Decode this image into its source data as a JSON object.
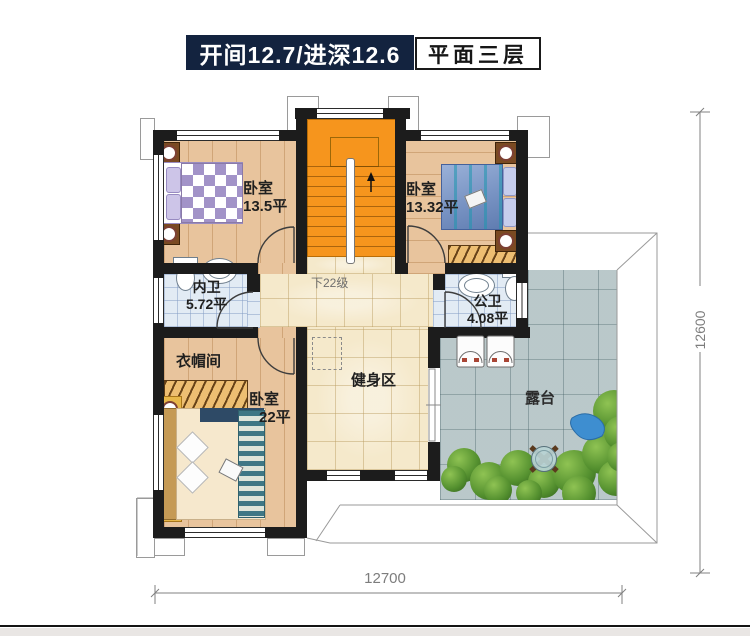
{
  "header": {
    "dimensions_label": "开间12.7/进深12.6",
    "floor_label": "平面三层"
  },
  "rooms": {
    "bedroom_top_left": {
      "name": "卧室",
      "area": "13.5平"
    },
    "bedroom_top_right": {
      "name": "卧室",
      "area": "13.32平"
    },
    "inner_bathroom": {
      "name": "内卫",
      "area": "5.72平"
    },
    "public_bathroom": {
      "name": "公卫",
      "area": "4.08平"
    },
    "cloakroom": {
      "name": "衣帽间"
    },
    "bedroom_bottom_left": {
      "name": "卧室",
      "area": "22平"
    },
    "gym": {
      "name": "健身区"
    },
    "terrace": {
      "name": "露台"
    },
    "stairs": {
      "note": "下22级"
    }
  },
  "dimensions": {
    "width": "12700",
    "height": "12600"
  },
  "colors": {
    "wall": "#1c1c1c",
    "header_navy": "#13233f",
    "stairs_orange": "#f6951d",
    "wood_floor": "#e6c096",
    "warm_tile": "#f5e9cb",
    "terrace_tile": "#b1c2c4",
    "bath_tile": "#e2ebf4",
    "wardrobe_hatch": "#edbe72",
    "greenery": "#54902f"
  }
}
